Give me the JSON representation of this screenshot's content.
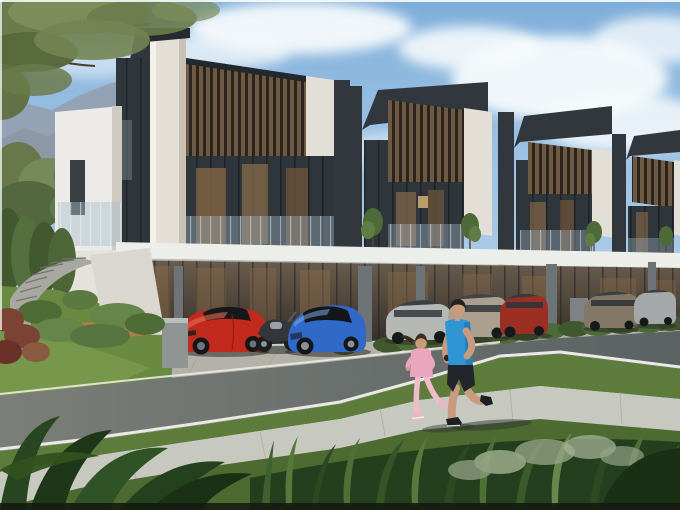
{
  "meta": {
    "alt": "Photorealistic architectural rendering of a row of modern two-storey townhouses with wood-slat screens and marble walls. Sports cars and SUVs are parked under the carports, a man in a blue shirt jogs on a sidewalk with a girl in pink, mountains and trees in the background, lush plants in the foreground."
  },
  "colors": {
    "sky": "#8fb9e0",
    "cloud": "#f6fafc",
    "mountain": "#93a0b0",
    "roof_dark": "#31373d",
    "marble": "#e4dfd6",
    "beam_white": "#eceee9",
    "column_gray": "#6e7377",
    "driveway": "#b4b1a8",
    "road": "#7b7e78",
    "curb": "#eaeae2",
    "grass": "#5d7c3b",
    "sidewalk": "#c7c9c1",
    "foreground_leaves": "#274621",
    "stair_gray": "#a7a8a0",
    "wood_deck": "#b08049",
    "shrub_red": "#7a4334",
    "ferrari_red": "#c22a1e",
    "porsche_blue": "#3069c8",
    "sedan_silver": "#b6b8b6",
    "suv_beige": "#ab9f90",
    "suv_red": "#9c2f24",
    "sedan_bronze": "#837767",
    "suv_silver": "#a5a8a8",
    "man_shirt": "#2f96d4",
    "man_shorts": "#22262b",
    "skin": "#c99b7e",
    "girl_outfit": "#e9a6bd",
    "girl_pants": "#f0bccb"
  },
  "scene": {
    "setting": "modern townhouse row with carports, road and jogging path",
    "vehicles": [
      "red sports car",
      "motorcycle",
      "blue sports car",
      "silver sedan",
      "beige SUV",
      "red SUV",
      "bronze sedan",
      "silver SUV"
    ],
    "people": [
      "man jogging in blue shirt and black shorts",
      "girl jogging in pink outfit"
    ],
    "landscape": [
      "mountains",
      "overhanging tree",
      "hedges",
      "curved garden staircase",
      "grass verges",
      "tropical foreground plants"
    ]
  }
}
